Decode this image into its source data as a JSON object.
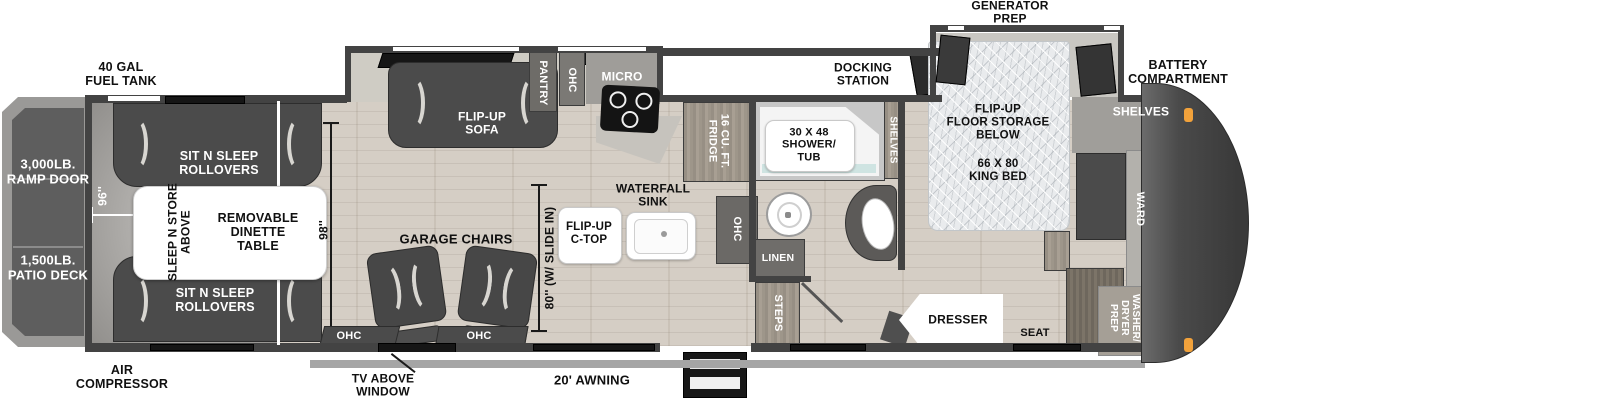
{
  "colors": {
    "wall": "#434343",
    "floor_wood": "#d5cec5",
    "floor_garage": "#a4a2a0",
    "slide_interior": "#cfccc4",
    "furniture_dark": "#4b4b4b",
    "white_surface": "#ffffff",
    "bed_mattress": "#e8eaec",
    "front_cap": "#454545",
    "awning_bar": "#a5a5a5",
    "marker_light_orange": "#f2a23b",
    "shower_water": "#cfe4e2"
  },
  "exterior": {
    "fuel_tank_label": "40 GAL\nFUEL TANK",
    "generator_prep_label": "GENERATOR\nPREP",
    "docking_station_label": "DOCKING\nSTATION",
    "battery_compartment_label": "BATTERY\nCOMPARTMENT",
    "air_compressor_label": "AIR\nCOMPRESSOR",
    "tv_above_window_label": "TV ABOVE\nWINDOW",
    "awning_label": "20' AWNING"
  },
  "rear_deck": {
    "ramp_door_label": "3,000LB.\nRAMP DOOR",
    "patio_deck_label": "1,500LB.\nPATIO DECK"
  },
  "garage": {
    "rollover_top_label": "SIT N SLEEP\nROLLOVERS",
    "rollover_bottom_label": "SIT N SLEEP\nROLLOVERS",
    "sleep_n_store_label": "SLEEP N STORE\nABOVE",
    "dinette_label": "REMOVABLE\nDINETTE\nTABLE",
    "chairs_label": "GARAGE CHAIRS",
    "ohc_left_label": "OHC",
    "ohc_right_label": "OHC",
    "width_dim": "96''",
    "length_dim": "98''"
  },
  "kitchen": {
    "sofa_label": "FLIP-UP\nSOFA",
    "pantry_label": "PANTRY",
    "ohc_label": "OHC",
    "micro_label": "MICRO",
    "fridge_label": "16 CU. FT.\nFRIDGE",
    "counter_ohc_label": "OHC",
    "waterfall_sink_label": "WATERFALL\nSINK",
    "flip_up_ctop_label": "FLIP-UP\nC-TOP",
    "slide_dim": "80'' (W/ SLIDE IN)"
  },
  "bathroom": {
    "shower_label": "30 X 48\nSHOWER/\nTUB",
    "linen_label": "LINEN",
    "steps_label": "STEPS",
    "shelves_label": "SHELVES"
  },
  "bedroom": {
    "floor_storage_label": "FLIP-UP\nFLOOR STORAGE\nBELOW",
    "king_bed_label": "66 X 80\nKING BED",
    "dresser_label": "DRESSER",
    "seat_label": "SEAT",
    "shelves_label": "SHELVES",
    "ward_label": "WARD",
    "washer_dryer_label": "WASHER/\nDRYER\nPREP"
  }
}
